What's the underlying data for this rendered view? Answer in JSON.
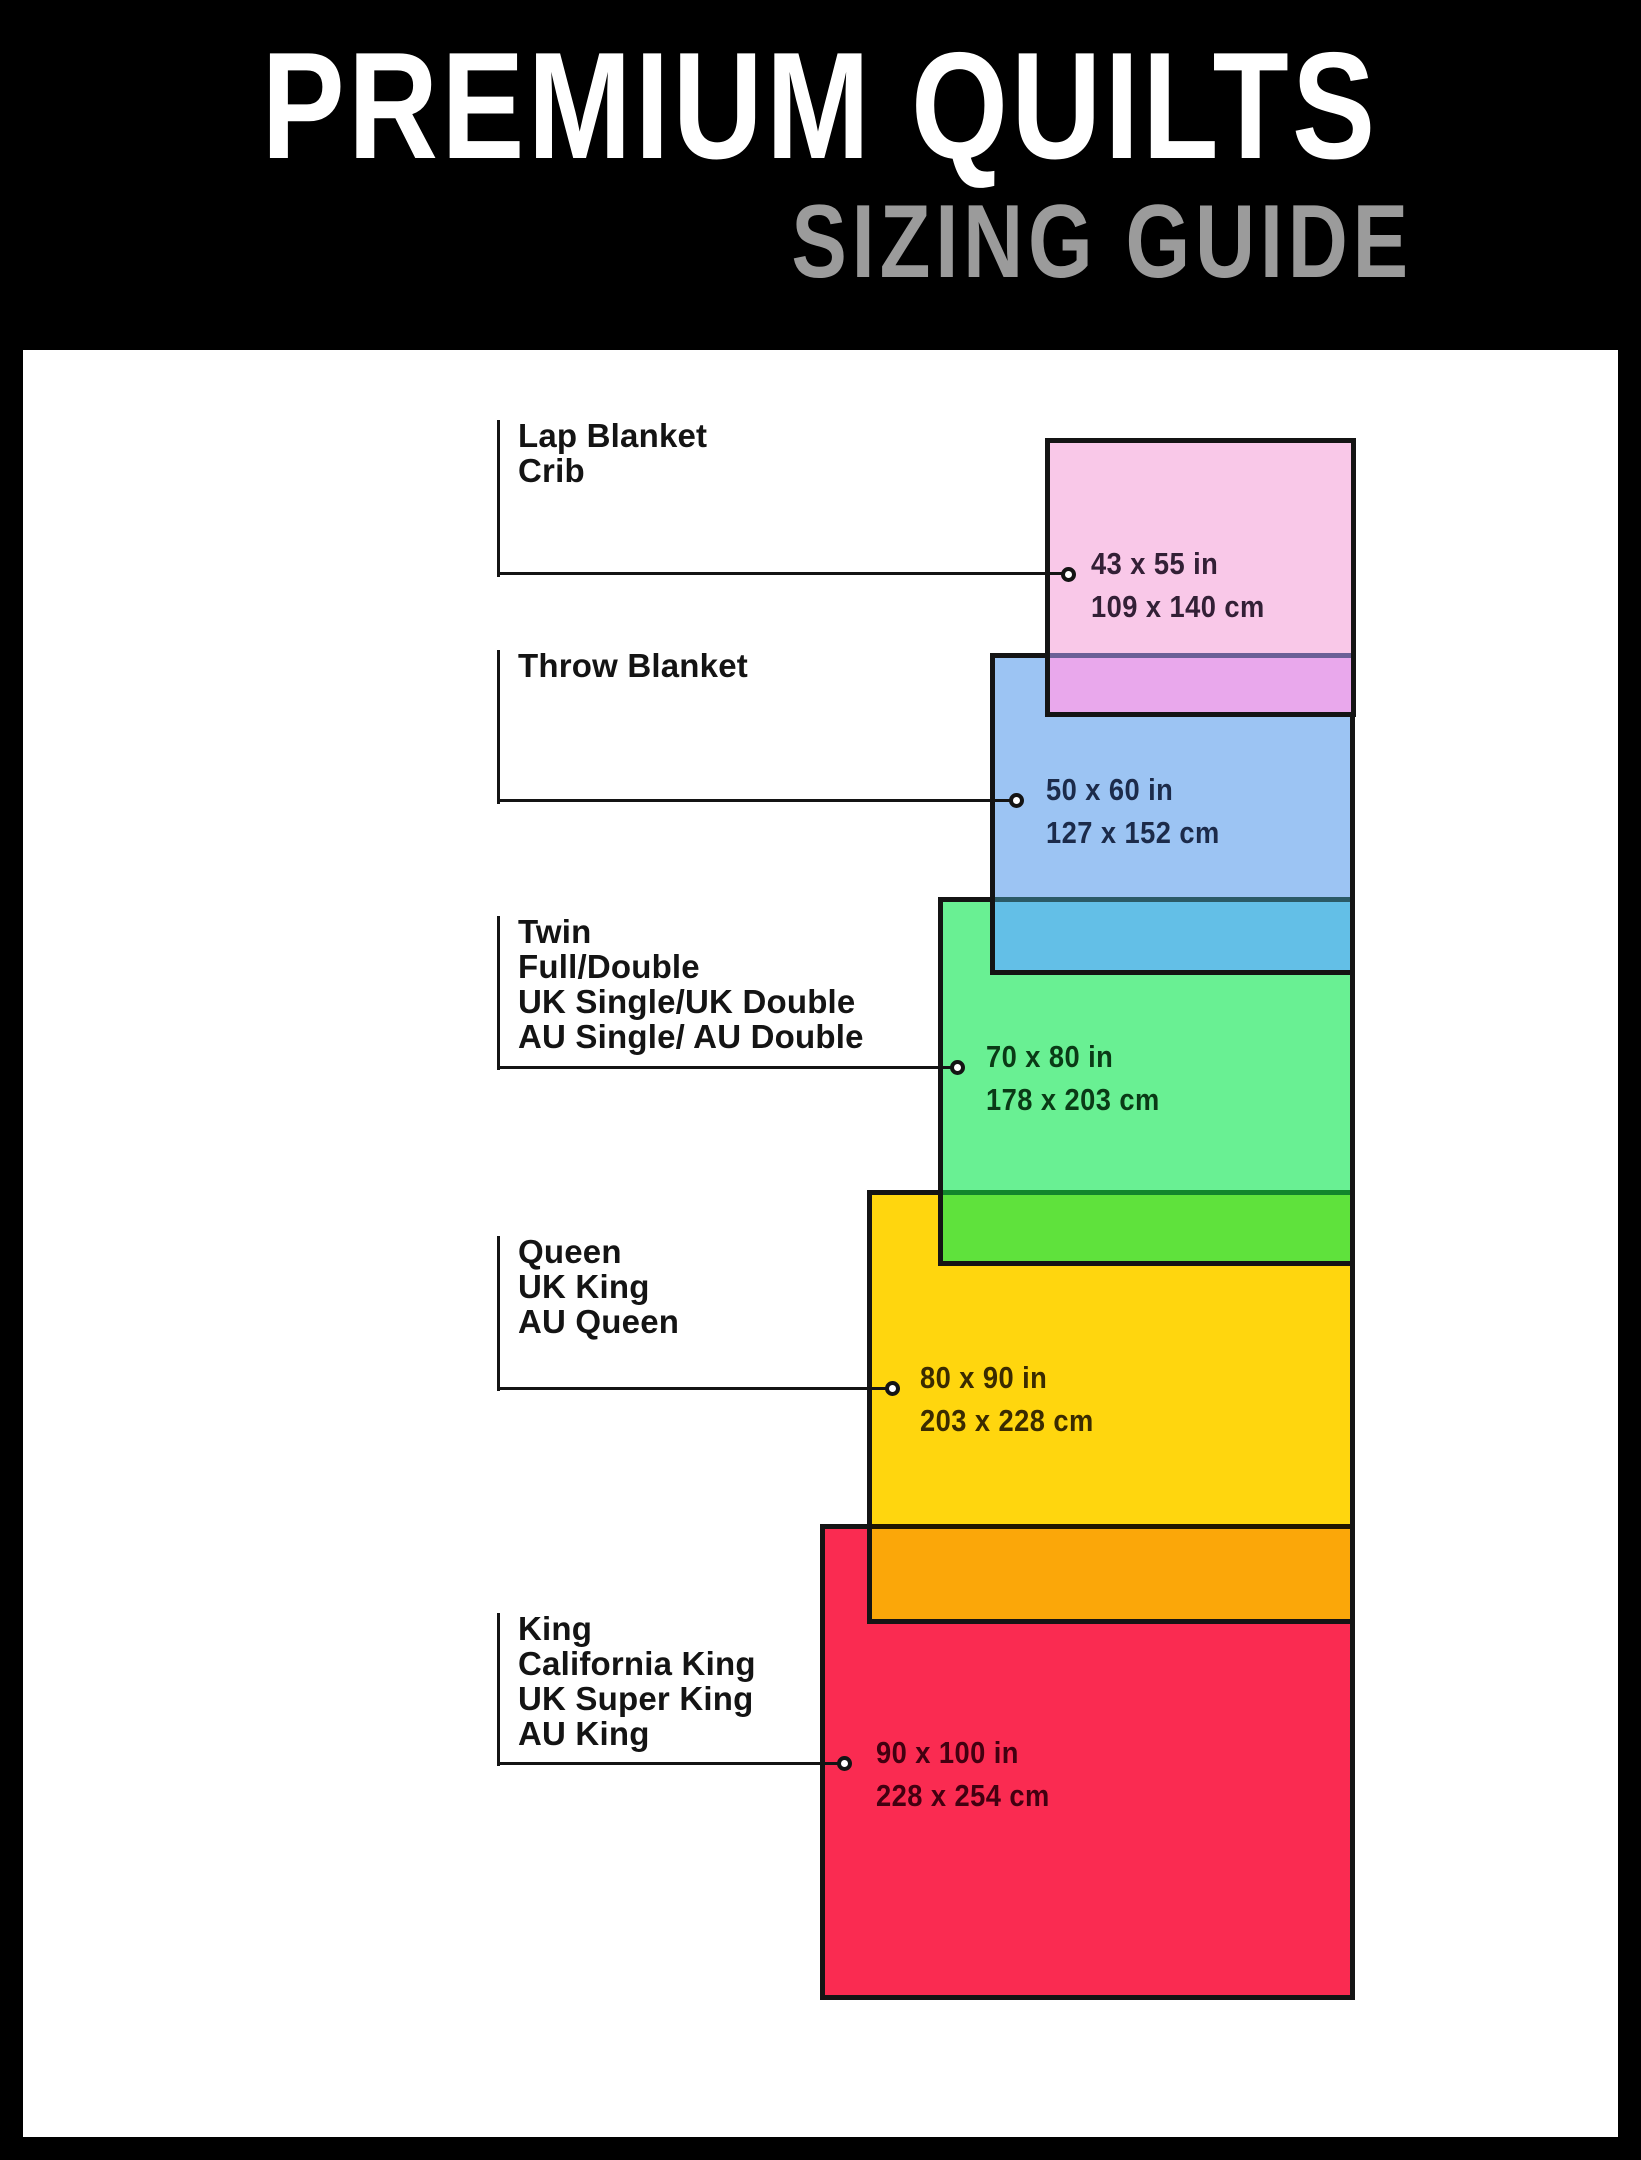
{
  "header": {
    "title": "PREMIUM QUILTS",
    "subtitle": "SIZING GUIDE",
    "title_color": "#ffffff",
    "subtitle_color": "#9b9b9b",
    "background": "#000000"
  },
  "canvas": {
    "background": "#ffffff",
    "frame_color": "#000000",
    "line_color": "#141414"
  },
  "sizes": [
    {
      "names": [
        "Lap Blanket",
        "Crib"
      ],
      "inches": "43 x 55 in",
      "cm": "109 x 140 cm",
      "fill": "#f9c8e8",
      "overlap_fill": "#e9a8ec",
      "overlap_line": "#6b6096",
      "text_color": "#332036"
    },
    {
      "names": [
        "Throw Blanket"
      ],
      "inches": "50 x 60 in",
      "cm": "127 x 152 cm",
      "fill": "#9cc4f3",
      "overlap_fill": "#63bfe7",
      "overlap_line": "#2b5a66",
      "text_color": "#1c2b4a"
    },
    {
      "names": [
        "Twin",
        "Full/Double",
        "UK Single/UK Double",
        "AU Single/ AU Double"
      ],
      "inches": "70 x 80 in",
      "cm": "178 x 203 cm",
      "fill": "#69f093",
      "overlap_fill": "#5fe23c",
      "overlap_line": "#12862c",
      "text_color": "#0a3a16"
    },
    {
      "names": [
        "Queen",
        "UK King",
        "AU Queen"
      ],
      "inches": "80 x 90 in",
      "cm": "203 x 228 cm",
      "fill": "#ffd60e",
      "overlap_fill": "#fba709",
      "overlap_line": "#201600",
      "text_color": "#3a2b00"
    },
    {
      "names": [
        "King",
        "California King",
        "UK Super King",
        "AU King"
      ],
      "inches": "90 x 100 in",
      "cm": "228 x 254 cm",
      "fill": "#fa2b51",
      "text_color": "#420010"
    }
  ]
}
